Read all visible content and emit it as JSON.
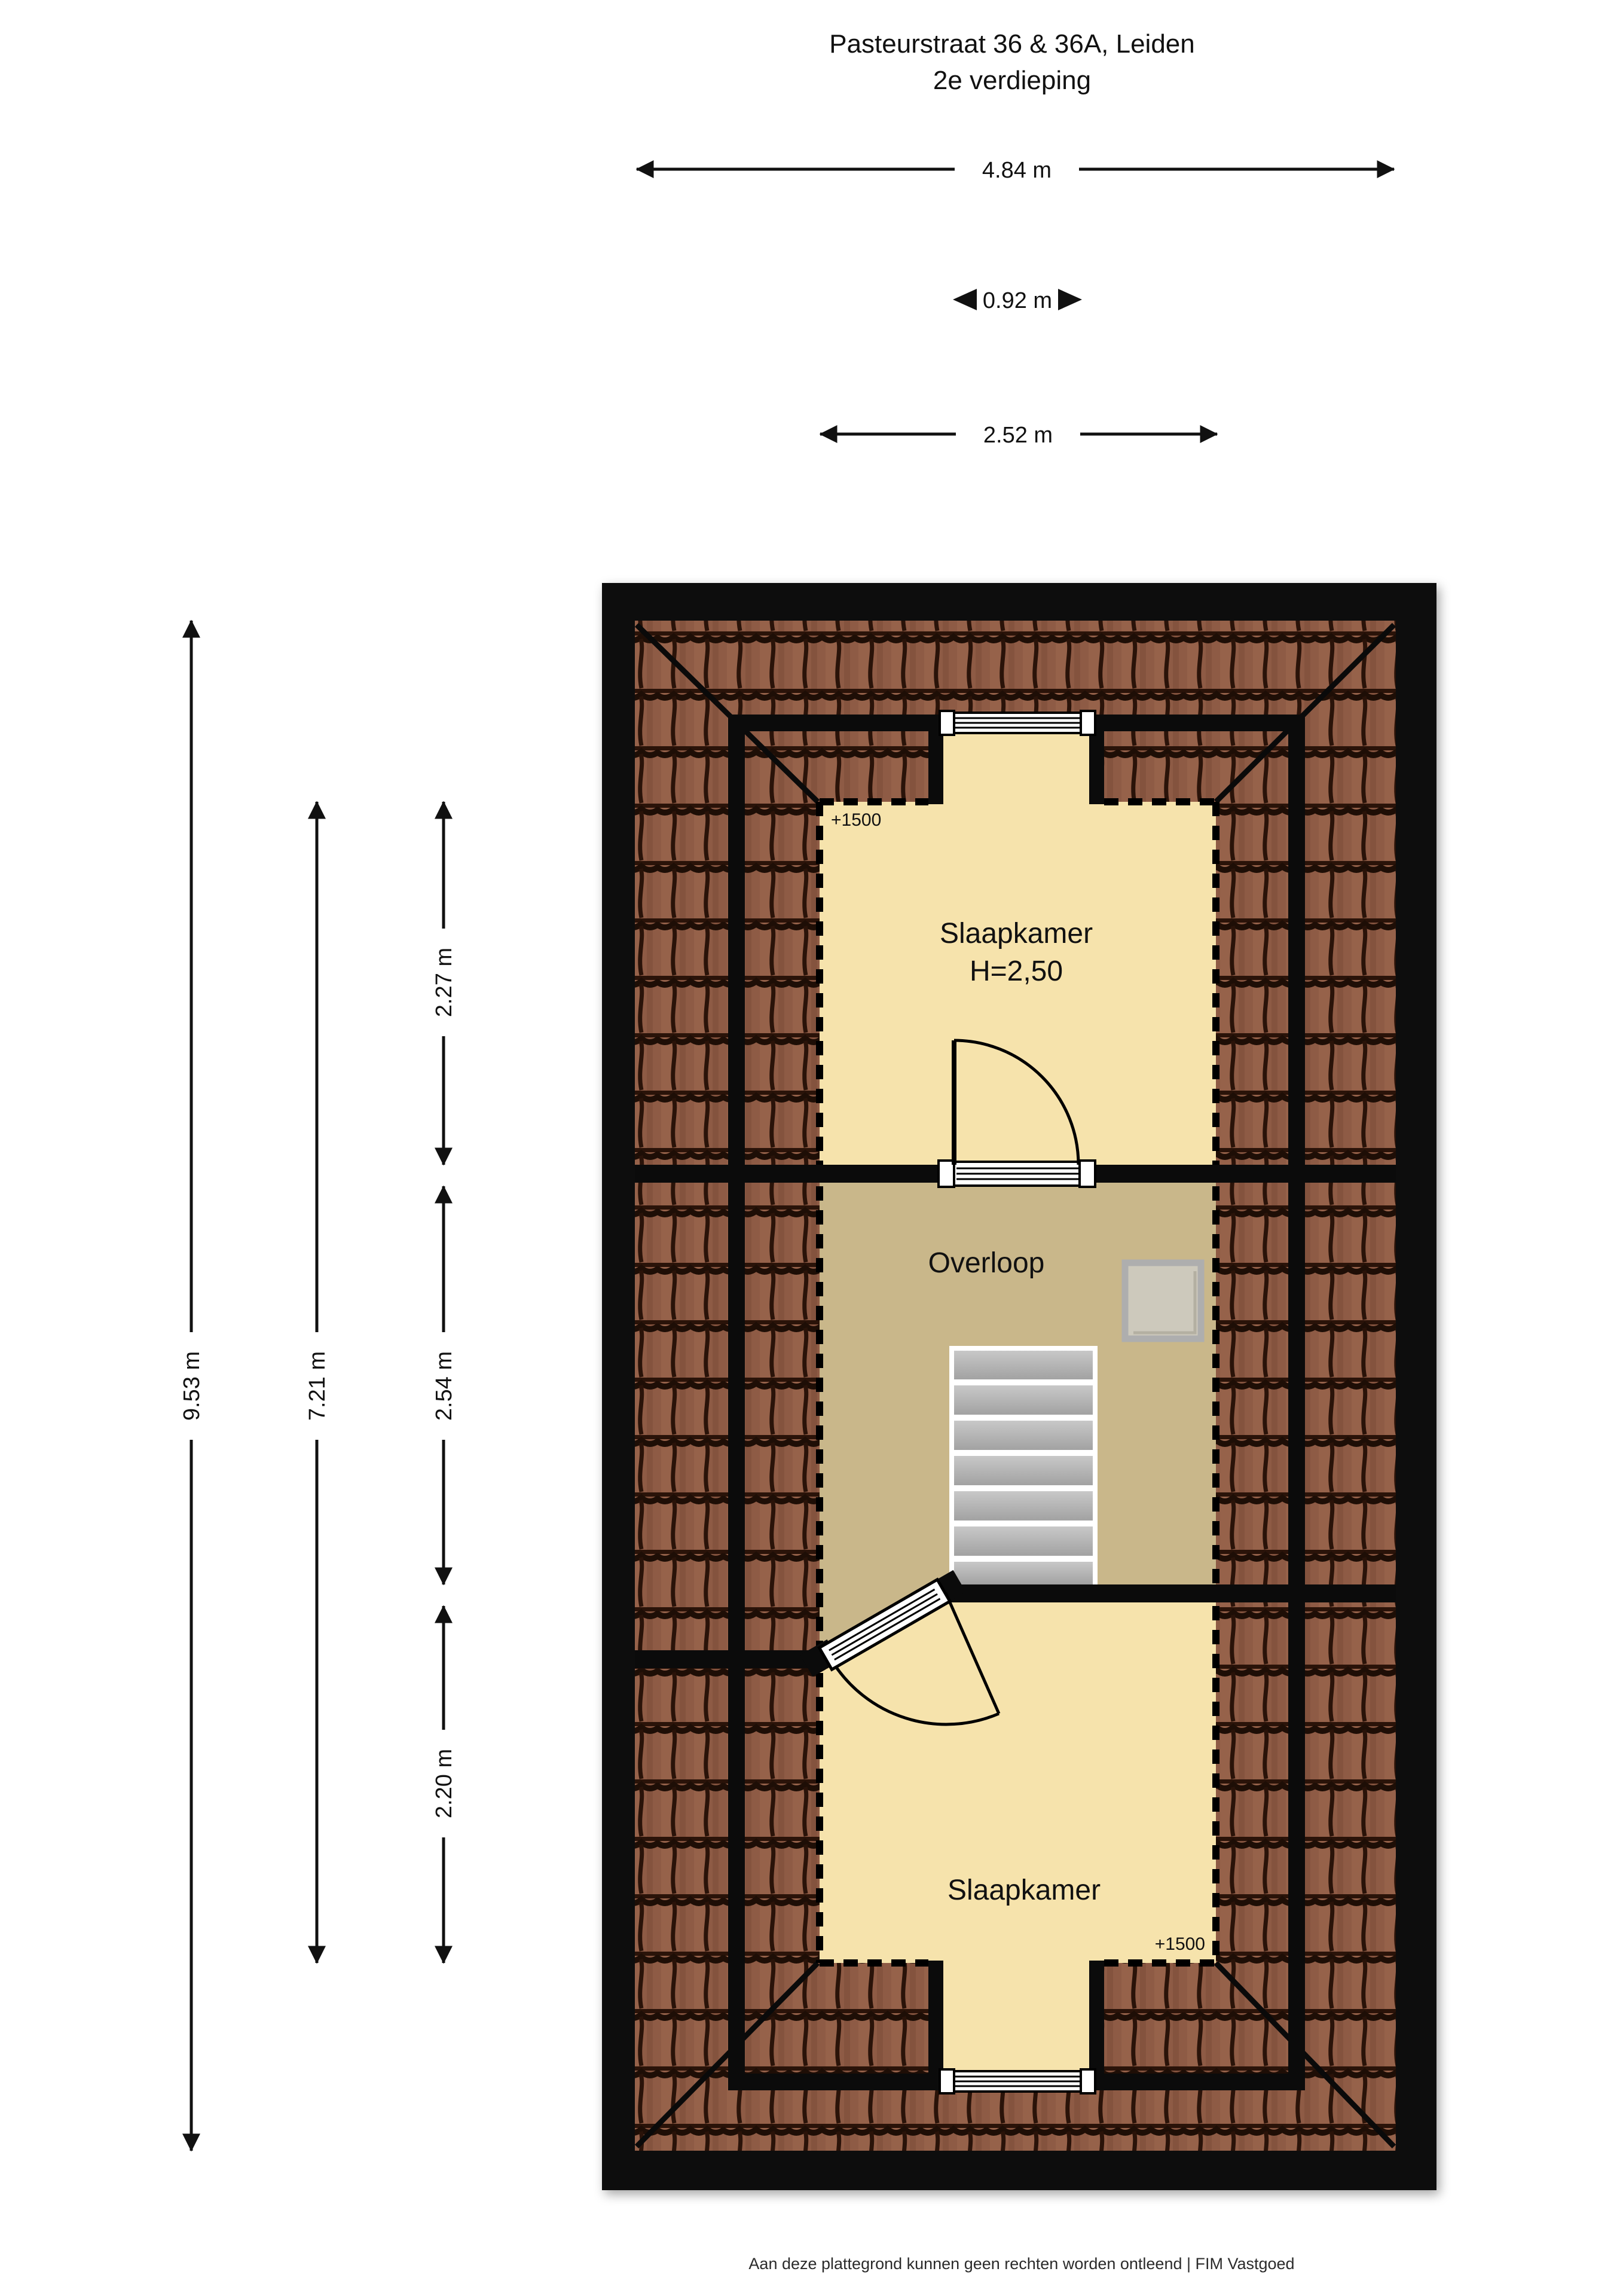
{
  "title": {
    "line1": "Pasteurstraat 36 & 36A, Leiden",
    "line2": "2e verdieping"
  },
  "measurements": {
    "total_width": "4.84 m",
    "dormer_width": "0.92 m",
    "inner_width": "2.52 m",
    "total_depth": "9.53 m",
    "inner_depth": "7.21 m",
    "bedroom_top_depth": "2.27 m",
    "landing_depth": "2.54 m",
    "bedroom_bottom_depth": "2.20 m"
  },
  "rooms": {
    "bedroom_top": {
      "label": "Slaapkamer",
      "ceiling": "H=2,50",
      "level": "+1500"
    },
    "landing": {
      "label": "Overloop"
    },
    "bedroom_bottom": {
      "label": "Slaapkamer",
      "level": "+1500"
    }
  },
  "footer": {
    "disclaimer": "Aan deze plattegrond kunnen geen rechten worden ontleend | FIM Vastgoed"
  },
  "colors": {
    "page_bg": "#ffffff",
    "wall_black": "#0b0b0b",
    "roof_tile_base": "#8e5b45",
    "room_cream": "#f6e3ac",
    "landing_tan": "#c9b78a",
    "stair_gray": "#b5b5b5",
    "skylight_fill": "#cdc9bc",
    "skylight_frame": "#aeaeae"
  }
}
